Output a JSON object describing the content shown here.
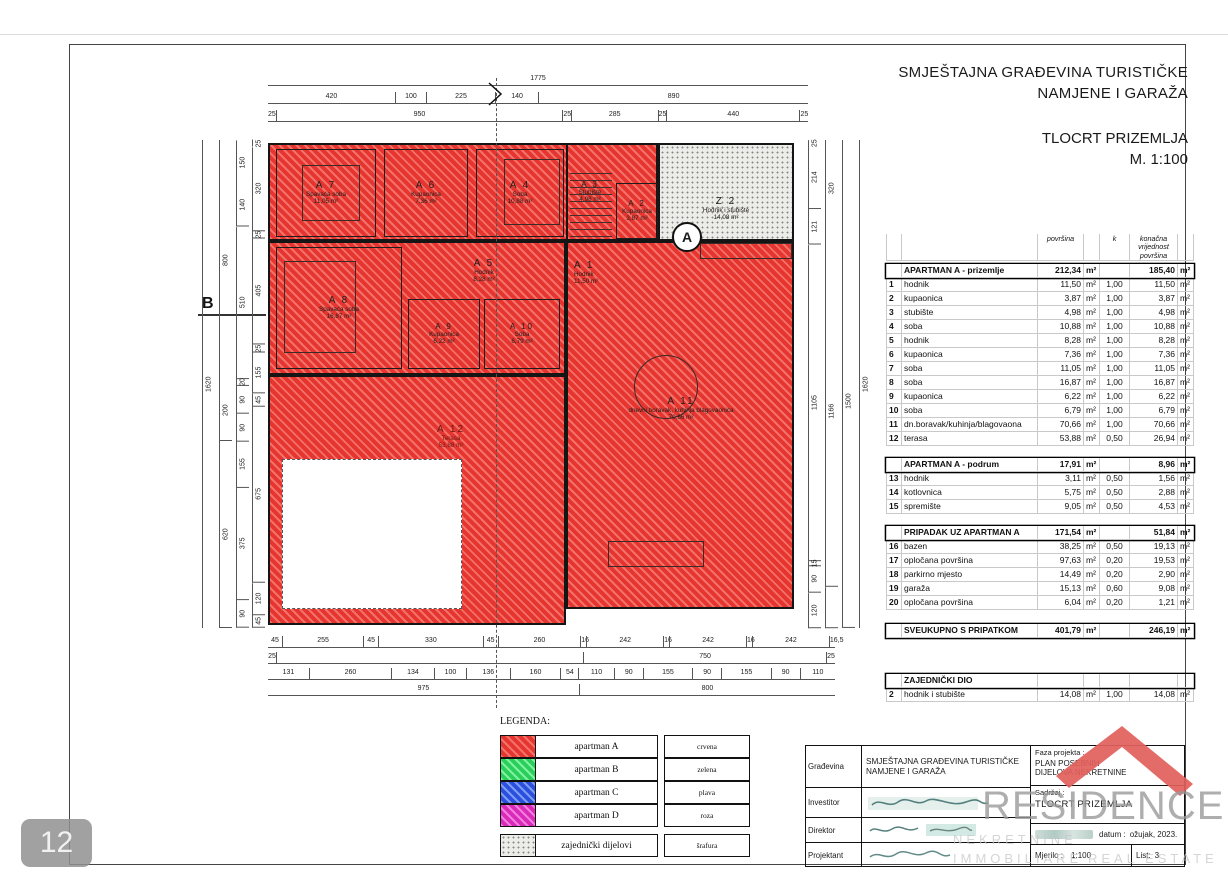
{
  "header": {
    "title_line1": "SMJEŠTAJNA GRAĐEVINA TURISTIČKE",
    "title_line2": "NAMJENE I GARAŽA",
    "drawing_name": "TLOCRT PRIZEMLJA",
    "scale": "M. 1:100"
  },
  "area_table": {
    "unit": "m²",
    "col_headers": [
      "površina",
      "k",
      "konačna vrijednost površina"
    ],
    "sections": [
      {
        "title": "APARTMAN A - prizemlje",
        "total": "212,34",
        "final": "185,40",
        "rows": [
          [
            "1",
            "hodnik",
            "11,50",
            "1,00",
            "11,50"
          ],
          [
            "2",
            "kupaonica",
            "3,87",
            "1,00",
            "3,87"
          ],
          [
            "3",
            "stubište",
            "4,98",
            "1,00",
            "4,98"
          ],
          [
            "4",
            "soba",
            "10,88",
            "1,00",
            "10,88"
          ],
          [
            "5",
            "hodnik",
            "8,28",
            "1,00",
            "8,28"
          ],
          [
            "6",
            "kupaonica",
            "7,36",
            "1,00",
            "7,36"
          ],
          [
            "7",
            "soba",
            "11,05",
            "1,00",
            "11,05"
          ],
          [
            "8",
            "soba",
            "16,87",
            "1,00",
            "16,87"
          ],
          [
            "9",
            "kupaonica",
            "6,22",
            "1,00",
            "6,22"
          ],
          [
            "10",
            "soba",
            "6,79",
            "1,00",
            "6,79"
          ],
          [
            "11",
            "dn.boravak/kuhinja/blagovaona",
            "70,66",
            "1,00",
            "70,66"
          ],
          [
            "12",
            "terasa",
            "53,88",
            "0,50",
            "26,94"
          ]
        ]
      },
      {
        "title": "APARTMAN A - podrum",
        "total": "17,91",
        "final": "8,96",
        "rows": [
          [
            "13",
            "hodnik",
            "3,11",
            "0,50",
            "1,56"
          ],
          [
            "14",
            "kotlovnica",
            "5,75",
            "0,50",
            "2,88"
          ],
          [
            "15",
            "spremište",
            "9,05",
            "0,50",
            "4,53"
          ]
        ]
      },
      {
        "title": "PRIPADAK UZ APARTMAN A",
        "total": "171,54",
        "final": "51,84",
        "rows": [
          [
            "16",
            "bazen",
            "38,25",
            "0,50",
            "19,13"
          ],
          [
            "17",
            "opločana površina",
            "97,63",
            "0,20",
            "19,53"
          ],
          [
            "18",
            "parkirno mjesto",
            "14,49",
            "0,20",
            "2,90"
          ],
          [
            "19",
            "garaža",
            "15,13",
            "0,60",
            "9,08"
          ],
          [
            "20",
            "opločana površina",
            "6,04",
            "0,20",
            "1,21"
          ]
        ]
      },
      {
        "title": "SVEUKUPNO S PRIPATKOM",
        "total": "401,79",
        "final": "246,19",
        "rows": []
      },
      {
        "title": "ZAJEDNIČKI DIO",
        "total": "",
        "final": "",
        "rows": [
          [
            "2",
            "hodnik i stubište",
            "14,08",
            "1,00",
            "14,08"
          ]
        ]
      }
    ]
  },
  "plan": {
    "rooms": [
      {
        "key": "A7",
        "id": "A 7",
        "name": "Spavaća soba",
        "area": "11,05 m²"
      },
      {
        "key": "A6",
        "id": "A 6",
        "name": "Kupaonica",
        "area": "7,36 m²"
      },
      {
        "key": "A4",
        "id": "A 4",
        "name": "Soba",
        "area": "10,88 m²"
      },
      {
        "key": "A3",
        "id": "A 3",
        "name": "Stubište",
        "area": "4,98 m²"
      },
      {
        "key": "A2",
        "id": "A 2",
        "name": "Kupaonica",
        "area": "3,87 m²"
      },
      {
        "key": "Z2",
        "id": "Z 2",
        "name": "Hodnik i stubište",
        "area": "14,08 m²"
      },
      {
        "key": "A8",
        "id": "A 8",
        "name": "Spavaća soba",
        "area": "16,87 m²"
      },
      {
        "key": "A5",
        "id": "A 5",
        "name": "Hodnik",
        "area": "8,28 m²"
      },
      {
        "key": "A9",
        "id": "A 9",
        "name": "Kupaonica",
        "area": "6,22 m²"
      },
      {
        "key": "A10",
        "id": "A 10",
        "name": "Soba",
        "area": "6,79 m²"
      },
      {
        "key": "A1",
        "id": "A 1",
        "name": "Hodnik",
        "area": "11,50 m²"
      },
      {
        "key": "A11",
        "id": "A 11",
        "name": "dnevni boravak, kuhinja blagovaonica",
        "area": "70,66 m²"
      },
      {
        "key": "A12",
        "id": "A 12",
        "name": "Terasa",
        "area": "53,88 m²"
      }
    ],
    "markers": {
      "section": "A",
      "grid": "B"
    }
  },
  "dimensions": {
    "top_rows": [
      [
        "1775"
      ],
      [
        "420",
        "100",
        "225",
        "140",
        "890"
      ],
      [
        "25",
        "950",
        "25",
        "285",
        "25",
        "440",
        "25"
      ]
    ],
    "bottom_rows": [
      [
        "45",
        "255",
        "45",
        "330",
        "45",
        "260",
        "16",
        "242",
        "16",
        "242",
        "16",
        "242",
        "16,5"
      ],
      [
        "25",
        "950*",
        "750",
        "25"
      ],
      [
        "131",
        "260",
        "134",
        "100",
        "136",
        "160",
        "54",
        "110",
        "90",
        "155",
        "90",
        "155",
        "90",
        "110"
      ],
      [
        "975",
        "800"
      ]
    ],
    "left_cols": [
      [
        "1620"
      ],
      [
        "800",
        "200",
        "620"
      ],
      [
        "150",
        "140",
        "510",
        "20",
        "90",
        "90",
        "155",
        "375",
        "90"
      ],
      [
        "25",
        "320",
        "25",
        "405",
        "25",
        "155",
        "45",
        "675",
        "120",
        "45"
      ]
    ],
    "right_cols": [
      [
        "25",
        "214",
        "121",
        "1105",
        "15",
        "90",
        "120"
      ],
      [
        "320",
        "1166",
        "134*"
      ],
      [
        "120*",
        "1500"
      ],
      [
        "1620"
      ]
    ]
  },
  "legend": {
    "title": "LEGENDA:",
    "items": [
      {
        "label": "apartman  A",
        "color_name": "crvena",
        "swatch": "red-hatch"
      },
      {
        "label": "apartman B",
        "color_name": "zelena",
        "swatch": "green-hatch"
      },
      {
        "label": "apartman C",
        "color_name": "plava",
        "swatch": "blue-hatch"
      },
      {
        "label": "apartman D",
        "color_name": "roza",
        "swatch": "magenta-hatch"
      },
      {
        "label": "zajednički dijelovi",
        "color_name": "šrafura",
        "swatch": "stipple"
      }
    ]
  },
  "title_block": {
    "rows": [
      {
        "label": "Građevina",
        "value": "SMJEŠTAJNA GRAĐEVINA TURISTIČKE NAMJENE I GARAŽA"
      },
      {
        "label": "Investitor",
        "value": ""
      },
      {
        "label": "Direktor",
        "value": ""
      },
      {
        "label": "Projektant",
        "value": ""
      }
    ],
    "faza_label": "Faza projekta :",
    "faza_value1": "PLAN POSEBNIH",
    "faza_value2": "DIJELOVA NEKRETNINE",
    "sadrzaj_label": "Sadržaj :",
    "sadrzaj_value": "TLOCRT PRIZEMLJA",
    "datum_label": "datum :",
    "datum_value": "ožujak, 2023.",
    "mjerilo_label": "Mjerilo :",
    "mjerilo_value": "1:100",
    "list_label": "List:",
    "list_value": "3"
  },
  "logo": {
    "text": "RESIDENCE",
    "watermarks": [
      "NEKRETNINE",
      "IMMOBILIARE",
      "REAL ESTATE"
    ],
    "roof_color": "#e2605c"
  },
  "badge": "12",
  "colors": {
    "apartment_red": "#e5352e",
    "apartment_green": "#2bce5a",
    "apartment_blue": "#2b50e0",
    "apartment_pink": "#d92bb8",
    "common_stipple": "#ecece8"
  }
}
